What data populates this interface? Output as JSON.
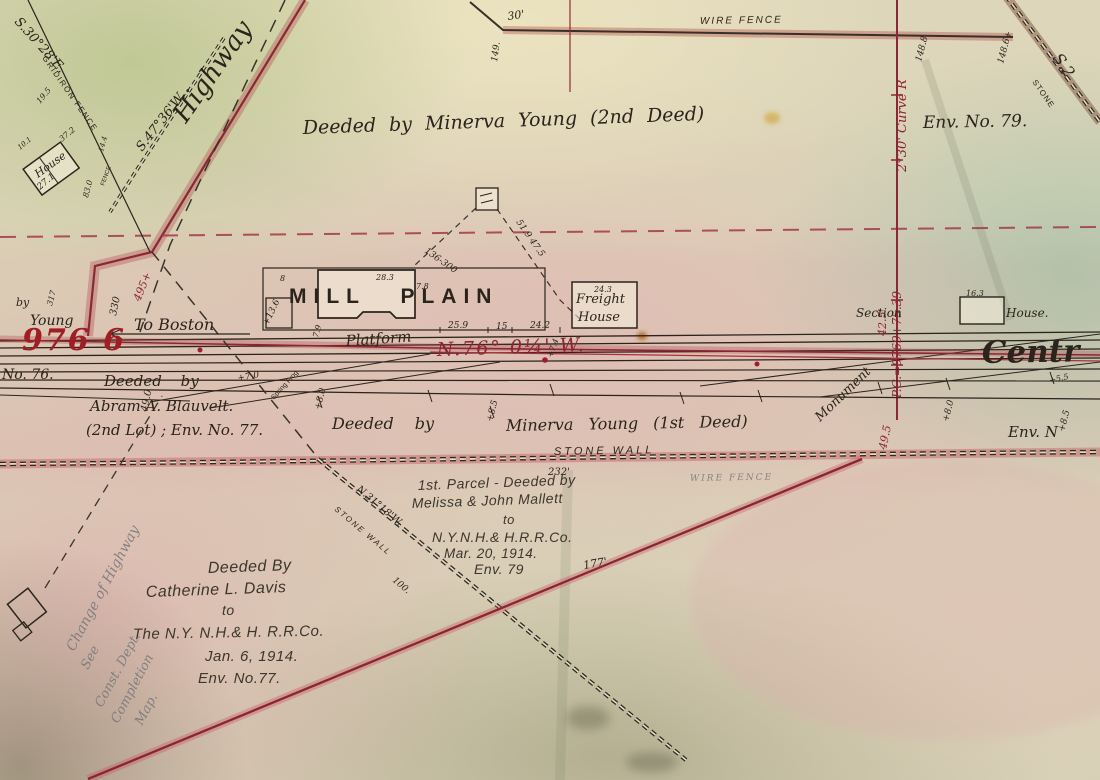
{
  "bearings": {
    "s3028e": "S.30°28'E.",
    "s4736w": "S.47°36'W.",
    "n76w": "N.76° 0¼' W.",
    "n3118w": "N.31°18'W.",
    "s2": "S.2",
    "curve": "2°30' Curve R",
    "pc_station": "P.C.=9769+75.39"
  },
  "fences": {
    "gridiron": "GRIDIRON FENCE",
    "wire_top": "WIRE FENCE",
    "wire_faint": "WIRE FENCE",
    "stone_wall_mid": "STONE WALL",
    "stone_wall_diag": "STONE WALL",
    "stone_tr": "STONE",
    "fence_small": "FENCE"
  },
  "places": {
    "highway": "Highway",
    "to_boston": "To Boston",
    "house": "House",
    "mill_plain": "MILL PLAIN",
    "platform": "Platform",
    "freight_1": "Freight",
    "freight_2": "House",
    "section_1": "Section",
    "section_2": "House.",
    "monument": "Monument",
    "central": "Centr",
    "spring_frog": "Spring Frog",
    "no76": "No. 76.",
    "val976": "976 6",
    "by": "by",
    "young": "Young"
  },
  "deeds": {
    "minerva2": "Deeded by Minerva Young (2nd Deed)",
    "env79_top": "Env. No. 79.",
    "minerva1_a": "Deeded by",
    "minerva1_b": "Minerva Young (1st Deed)",
    "blauvelt_1": "Deeded by",
    "blauvelt_2": "Abram A. Blauvelt.",
    "blauvelt_3": "(2nd Lot) ; Env. No. 77.",
    "mallett_1": "1st. Parcel - Deeded by",
    "mallett_2": "Melissa & John Mallett",
    "mallett_3": "to",
    "mallett_4": "N.Y.N.H.& H.R.R.Co.",
    "mallett_5": "Mar. 20, 1914.",
    "mallett_6": "Env. 79",
    "davis_1": "Deeded By",
    "davis_2": "Catherine L. Davis",
    "davis_3": "to",
    "davis_4": "The N.Y. N.H.& H. R.R.Co.",
    "davis_5": "Jan. 6, 1914.",
    "davis_6": "Env. No.77.",
    "env_bottom_right": "Env. N"
  },
  "pencil_notes": {
    "change_1": "Change of Highway",
    "change_2": "See",
    "change_3": "Const. Dept.",
    "change_4": "Completion",
    "change_5": "Map."
  },
  "dims": {
    "d30": "30'",
    "d149": "149.",
    "d148_8": "148.8",
    "d148_6": "148.6+",
    "d19_5": "19.5",
    "d37_2": "37.2",
    "d27_1": "27.1",
    "d10_1": "10.1",
    "d14_4": "14.4",
    "d83": "83.0",
    "d317": "317",
    "d330": "330",
    "d495": "495+",
    "d49_0": "49.0",
    "d13_6": "+13.6",
    "d7_0": "+7.0",
    "d136_300": "136-300",
    "d51_9": "51.9 47.5",
    "d8": "8",
    "d28_3": "28.3",
    "d7_8": "7.8",
    "d7_9": "7.9",
    "d25_9": "25.9",
    "d15": "15",
    "d24_2": "24.2",
    "d24_3": "24.3",
    "d16_3": "16.3",
    "d232": "232'",
    "d177": "177'",
    "d100": "100.",
    "d42_5": "42.5'",
    "d49_5": "49.5",
    "d8_0a": "+8.0",
    "d8_0b": "+8.0",
    "d8_5a": "+8.5",
    "d8_5b": "+8.5",
    "d7_4": "+7.4",
    "d5_5": "+5.5"
  }
}
